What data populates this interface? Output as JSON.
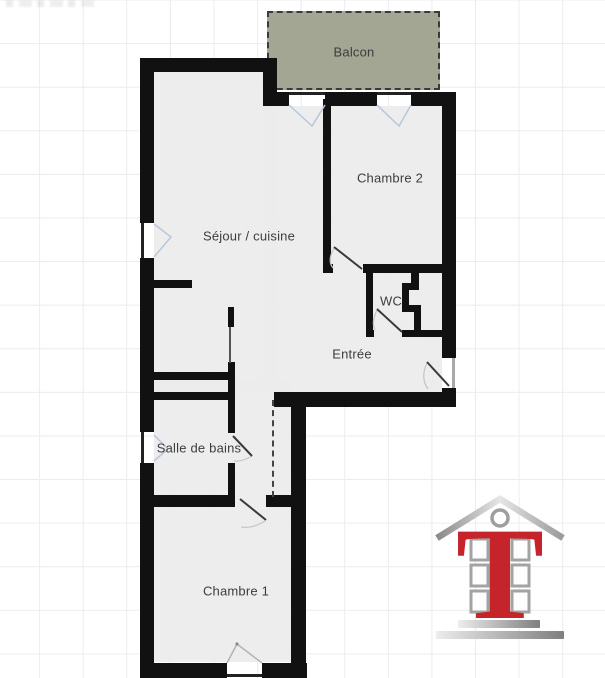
{
  "plan": {
    "type": "floor-plan",
    "rooms": [
      {
        "id": "balcon",
        "label": "Balcon"
      },
      {
        "id": "chambre2",
        "label": "Chambre 2"
      },
      {
        "id": "sejour",
        "label": "Séjour / cuisine"
      },
      {
        "id": "wc",
        "label": "WC"
      },
      {
        "id": "entree",
        "label": "Entrée"
      },
      {
        "id": "sdb",
        "label": "Salle de bains"
      },
      {
        "id": "chambre1",
        "label": "Chambre 1"
      }
    ],
    "colors": {
      "wall": "#111111",
      "floor": "#f0f0f0",
      "balcony_fill": "#a2a693",
      "balcony_border": "#3a3a3a",
      "grid_line": "#ececec",
      "door_leaf": "#3a3a3a",
      "swing_arc": "#c6c6c6",
      "window_casement": "#b6c8da",
      "label_text": "#3d3d3d"
    }
  },
  "logo": {
    "letter": "T",
    "red": "#c5242b",
    "silver": "#9a9a9a"
  }
}
